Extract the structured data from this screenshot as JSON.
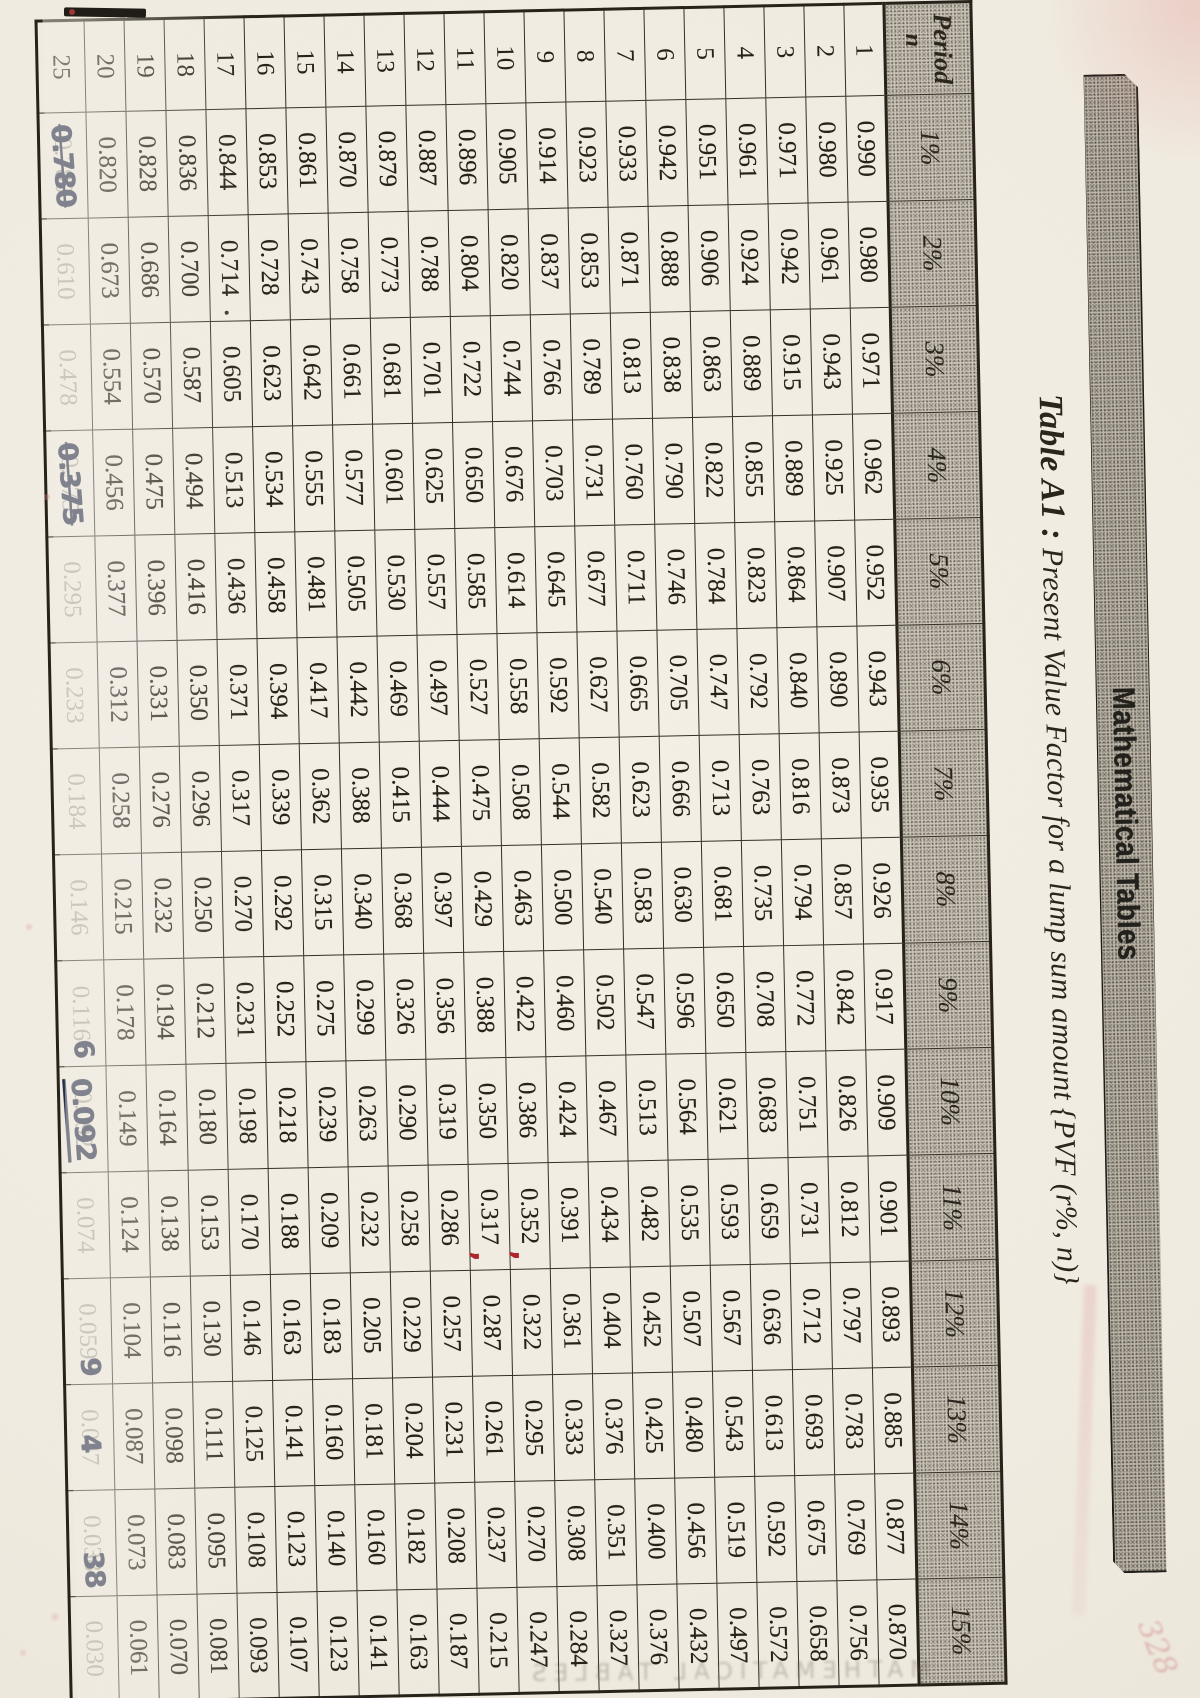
{
  "page": {
    "banner_label": "Mathematical Tables",
    "title_lead": "Table A1 :",
    "title_rest": " Present Value Factor for a lump sum amount {PVF (r%, n)}"
  },
  "table": {
    "corner_line1": "Period",
    "corner_line2": "n",
    "rate_headers": [
      "1%",
      "2%",
      "3%",
      "4%",
      "5%",
      "6%",
      "7%",
      "8%",
      "9%",
      "10%",
      "11%",
      "12%",
      "13%",
      "14%",
      "15%"
    ],
    "rows": [
      {
        "period": "1",
        "values": [
          "0.990",
          "0.980",
          "0.971",
          "0.962",
          "0.952",
          "0.943",
          "0.935",
          "0.926",
          "0.917",
          "0.909",
          "0.901",
          "0.893",
          "0.885",
          "0.877",
          "0.870"
        ]
      },
      {
        "period": "2",
        "values": [
          "0.980",
          "0.961",
          "0.943",
          "0.925",
          "0.907",
          "0.890",
          "0.873",
          "0.857",
          "0.842",
          "0.826",
          "0.812",
          "0.797",
          "0.783",
          "0.769",
          "0.756"
        ]
      },
      {
        "period": "3",
        "values": [
          "0.971",
          "0.942",
          "0.915",
          "0.889",
          "0.864",
          "0.840",
          "0.816",
          "0.794",
          "0.772",
          "0.751",
          "0.731",
          "0.712",
          "0.693",
          "0.675",
          "0.658"
        ]
      },
      {
        "period": "4",
        "values": [
          "0.961",
          "0.924",
          "0.889",
          "0.855",
          "0.823",
          "0.792",
          "0.763",
          "0.735",
          "0.708",
          "0.683",
          "0.659",
          "0.636",
          "0.613",
          "0.592",
          "0.572"
        ]
      },
      {
        "period": "5",
        "values": [
          "0.951",
          "0.906",
          "0.863",
          "0.822",
          "0.784",
          "0.747",
          "0.713",
          "0.681",
          "0.650",
          "0.621",
          "0.593",
          "0.567",
          "0.543",
          "0.519",
          "0.497"
        ]
      },
      {
        "period": "6",
        "values": [
          "0.942",
          "0.888",
          "0.838",
          "0.790",
          "0.746",
          "0.705",
          "0.666",
          "0.630",
          "0.596",
          "0.564",
          "0.535",
          "0.507",
          "0.480",
          "0.456",
          "0.432"
        ]
      },
      {
        "period": "7",
        "values": [
          "0.933",
          "0.871",
          "0.813",
          "0.760",
          "0.711",
          "0.665",
          "0.623",
          "0.583",
          "0.547",
          "0.513",
          "0.482",
          "0.452",
          "0.425",
          "0.400",
          "0.376"
        ]
      },
      {
        "period": "8",
        "values": [
          "0.923",
          "0.853",
          "0.789",
          "0.731",
          "0.677",
          "0.627",
          "0.582",
          "0.540",
          "0.502",
          "0.467",
          "0.434",
          "0.404",
          "0.376",
          "0.351",
          "0.327"
        ]
      },
      {
        "period": "9",
        "values": [
          "0.914",
          "0.837",
          "0.766",
          "0.703",
          "0.645",
          "0.592",
          "0.544",
          "0.500",
          "0.460",
          "0.424",
          "0.391",
          "0.361",
          "0.333",
          "0.308",
          "0.284"
        ]
      },
      {
        "period": "10",
        "values": [
          "0.905",
          "0.820",
          "0.744",
          "0.676",
          "0.614",
          "0.558",
          "0.508",
          "0.463",
          "0.422",
          "0.386",
          "0.352",
          "0.322",
          "0.295",
          "0.270",
          "0.247"
        ]
      },
      {
        "period": "11",
        "values": [
          "0.896",
          "0.804",
          "0.722",
          "0.650",
          "0.585",
          "0.527",
          "0.475",
          "0.429",
          "0.388",
          "0.350",
          "0.317",
          "0.287",
          "0.261",
          "0.237",
          "0.215"
        ]
      },
      {
        "period": "12",
        "values": [
          "0.887",
          "0.788",
          "0.701",
          "0.625",
          "0.557",
          "0.497",
          "0.444",
          "0.397",
          "0.356",
          "0.319",
          "0.286",
          "0.257",
          "0.231",
          "0.208",
          "0.187"
        ]
      },
      {
        "period": "13",
        "values": [
          "0.879",
          "0.773",
          "0.681",
          "0.601",
          "0.530",
          "0.469",
          "0.415",
          "0.368",
          "0.326",
          "0.290",
          "0.258",
          "0.229",
          "0.204",
          "0.182",
          "0.163"
        ]
      },
      {
        "period": "14",
        "values": [
          "0.870",
          "0.758",
          "0.661",
          "0.577",
          "0.505",
          "0.442",
          "0.388",
          "0.340",
          "0.299",
          "0.263",
          "0.232",
          "0.205",
          "0.181",
          "0.160",
          "0.141"
        ]
      },
      {
        "period": "15",
        "values": [
          "0.861",
          "0.743",
          "0.642",
          "0.555",
          "0.481",
          "0.417",
          "0.362",
          "0.315",
          "0.275",
          "0.239",
          "0.209",
          "0.183",
          "0.160",
          "0.140",
          "0.123"
        ]
      },
      {
        "period": "16",
        "values": [
          "0.853",
          "0.728",
          "0.623",
          "0.534",
          "0.458",
          "0.394",
          "0.339",
          "0.292",
          "0.252",
          "0.218",
          "0.188",
          "0.163",
          "0.141",
          "0.123",
          "0.107"
        ]
      },
      {
        "period": "17",
        "values": [
          "0.844",
          "0.714",
          "0.605",
          "0.513",
          "0.436",
          "0.371",
          "0.317",
          "0.270",
          "0.231",
          "0.198",
          "0.170",
          "0.146",
          "0.125",
          "0.108",
          "0.093"
        ]
      },
      {
        "period": "18",
        "values": [
          "0.836",
          "0.700",
          "0.587",
          "0.494",
          "0.416",
          "0.350",
          "0.296",
          "0.250",
          "0.212",
          "0.180",
          "0.153",
          "0.130",
          "0.111",
          "0.095",
          "0.081"
        ]
      },
      {
        "period": "19",
        "values": [
          "0.828",
          "0.686",
          "0.570",
          "0.475",
          "0.396",
          "0.331",
          "0.276",
          "0.232",
          "0.194",
          "0.164",
          "0.138",
          "0.116",
          "0.098",
          "0.083",
          "0.070"
        ]
      },
      {
        "period": "20",
        "values": [
          "0.820",
          "0.673",
          "0.554",
          "0.456",
          "0.377",
          "0.312",
          "0.258",
          "0.215",
          "0.178",
          "0.149",
          "0.124",
          "0.104",
          "0.087",
          "0.073",
          "0.061"
        ]
      },
      {
        "period": "25",
        "faint": true,
        "tall": true,
        "values": [
          "0.780",
          "0.610",
          "0.478",
          "0.375",
          "0.295",
          "0.233",
          "0.184",
          "0.146",
          "0.116",
          "0.092",
          "0.074",
          "0.059",
          "0.047",
          "0.038",
          "0.030"
        ]
      }
    ],
    "ink_overlays": [
      {
        "period": "25",
        "col": 0,
        "text": "0.780",
        "mode": "full",
        "strike": true
      },
      {
        "period": "25",
        "col": 3,
        "text": "0.375",
        "mode": "full",
        "strike": true
      },
      {
        "period": "25",
        "col": 8,
        "text": "6",
        "mode": "end"
      },
      {
        "period": "25",
        "col": 9,
        "text": "0.092",
        "mode": "full",
        "underline": true
      },
      {
        "period": "25",
        "col": 11,
        "text": "9",
        "mode": "end"
      },
      {
        "period": "25",
        "col": 12,
        "text": "4",
        "mode": "mid"
      },
      {
        "period": "25",
        "col": 13,
        "text": "38",
        "mode": "end"
      }
    ],
    "red_marks": [
      {
        "period": "11",
        "col": 10
      },
      {
        "period": "10",
        "col": 10
      }
    ],
    "stray_dots": [
      {
        "period": "17",
        "col": 1
      }
    ]
  },
  "artifacts": {
    "ghost_bleed_text": "MATHEMATICAL TABLES",
    "corner_scribble": "328"
  }
}
